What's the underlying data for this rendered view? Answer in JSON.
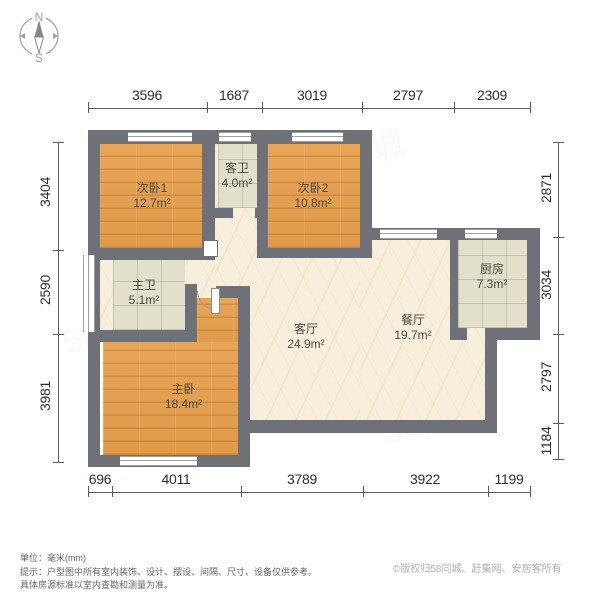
{
  "compass": {
    "north": "N",
    "south": "S"
  },
  "dimensions": {
    "top": [
      "3596",
      "1687",
      "3019",
      "2797",
      "2309"
    ],
    "bottom": [
      "696",
      "4011",
      "3789",
      "3922",
      "1199"
    ],
    "left": [
      "3404",
      "2590",
      "3981"
    ],
    "right": [
      "2871",
      "3034",
      "2797",
      "1184"
    ]
  },
  "rooms": {
    "bedroom1": {
      "name": "次卧1",
      "area": "12.7m²"
    },
    "guest_bath": {
      "name": "客卫",
      "area": "4.0m²"
    },
    "bedroom2": {
      "name": "次卧2",
      "area": "10.8m²"
    },
    "master_bath": {
      "name": "主卫",
      "area": "5.1m²"
    },
    "living_room": {
      "name": "客厅",
      "area": "24.9m²"
    },
    "dining_room": {
      "name": "餐厅",
      "area": "19.7m²"
    },
    "kitchen": {
      "name": "厨房",
      "area": "7.3m²"
    },
    "master_bedroom": {
      "name": "主卧",
      "area": "18.4m²"
    }
  },
  "footer": {
    "unit": "单位：毫米(mm)",
    "tip_line1": "提示：户型图中所有室内装饰、设计、摆设、间隔、尺寸、设备仅供参考。",
    "tip_line2": "具体房源标准以室内查勘和测量为准。",
    "copyright": "©版权归58同城、赶集网、安居客所有"
  },
  "watermark_text": "58同城",
  "colors": {
    "wall": "#6e7177",
    "bedroom_floor": "#e6a257",
    "tile_floor": "#e2e0ca",
    "living_floor": "#f7efdb",
    "dim_line": "#5c5c5c"
  }
}
